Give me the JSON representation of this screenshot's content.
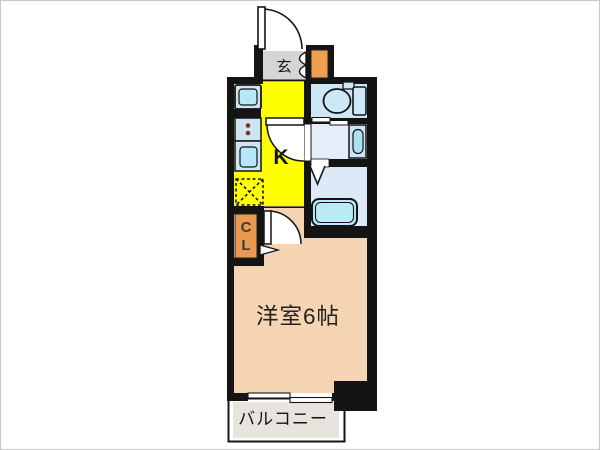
{
  "floorplan": {
    "labels": {
      "entrance": "玄",
      "kitchen": "K",
      "closet_line1": "C",
      "closet_line2": "L",
      "main_room": "洋室6帖",
      "balcony": "バルコニー"
    },
    "colors": {
      "wall": "#141414",
      "kitchen_floor": "#ffff00",
      "room_floor": "#f5d4b3",
      "entrance_floor": "#d5d5d5",
      "balcony_floor": "#e7e3dd",
      "closet": "#ea9a50",
      "shoe_box": "#ef9f4e",
      "toilet_floor": "#cde7f7",
      "washroom_floor": "#e4eef9",
      "bath_floor": "#dbeaf6",
      "fixture_fill": "#cde9f8",
      "fixture_inner": "#b5e7f7",
      "counter_fill": "#cde4f4",
      "basin_inner": "#ace2f2",
      "tub_fill": "#baeaf5",
      "stove_dot": "#7c3210"
    }
  }
}
